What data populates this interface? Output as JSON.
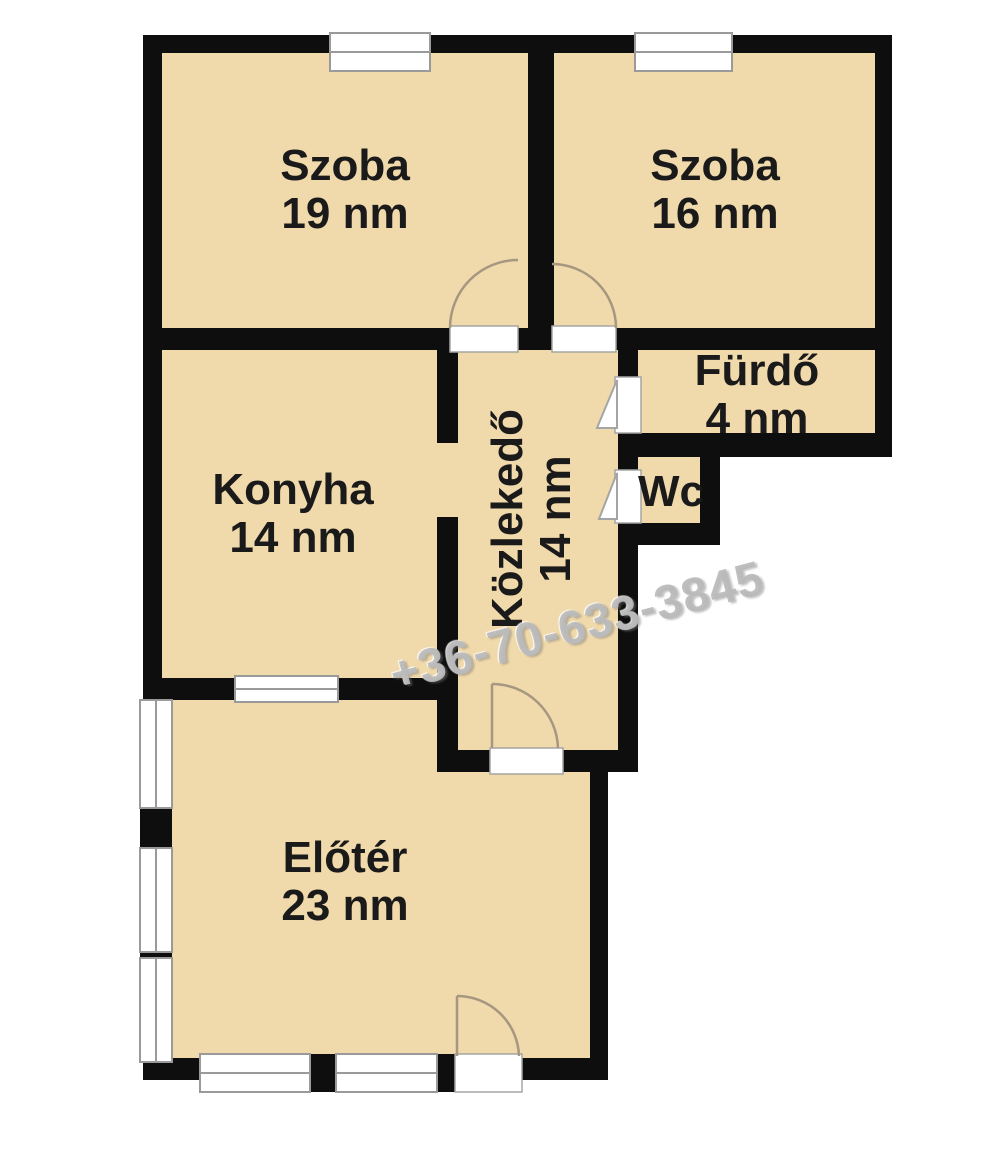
{
  "plan": {
    "rooms": [
      {
        "id": "szoba-19",
        "name": "Szoba",
        "area": "19 nm"
      },
      {
        "id": "szoba-16",
        "name": "Szoba",
        "area": "16 nm"
      },
      {
        "id": "furdo",
        "name": "Fürdő",
        "area": "4 nm"
      },
      {
        "id": "wc",
        "name": "Wc",
        "area": ""
      },
      {
        "id": "konyha",
        "name": "Konyha",
        "area": "14 nm"
      },
      {
        "id": "kozlekedo",
        "name": "Közlekedő",
        "area": "14 nm"
      },
      {
        "id": "eloter",
        "name": "Előtér",
        "area": "23 nm"
      }
    ],
    "watermark": "+36-70-633-3845",
    "colors": {
      "floor": "#f0d9aa",
      "wall": "#0e0e0e",
      "window": "#ffffff",
      "background": "#ffffff",
      "label_text": "#1a1a1a",
      "door_arc": "#a59780",
      "watermark": "#bababa"
    }
  }
}
